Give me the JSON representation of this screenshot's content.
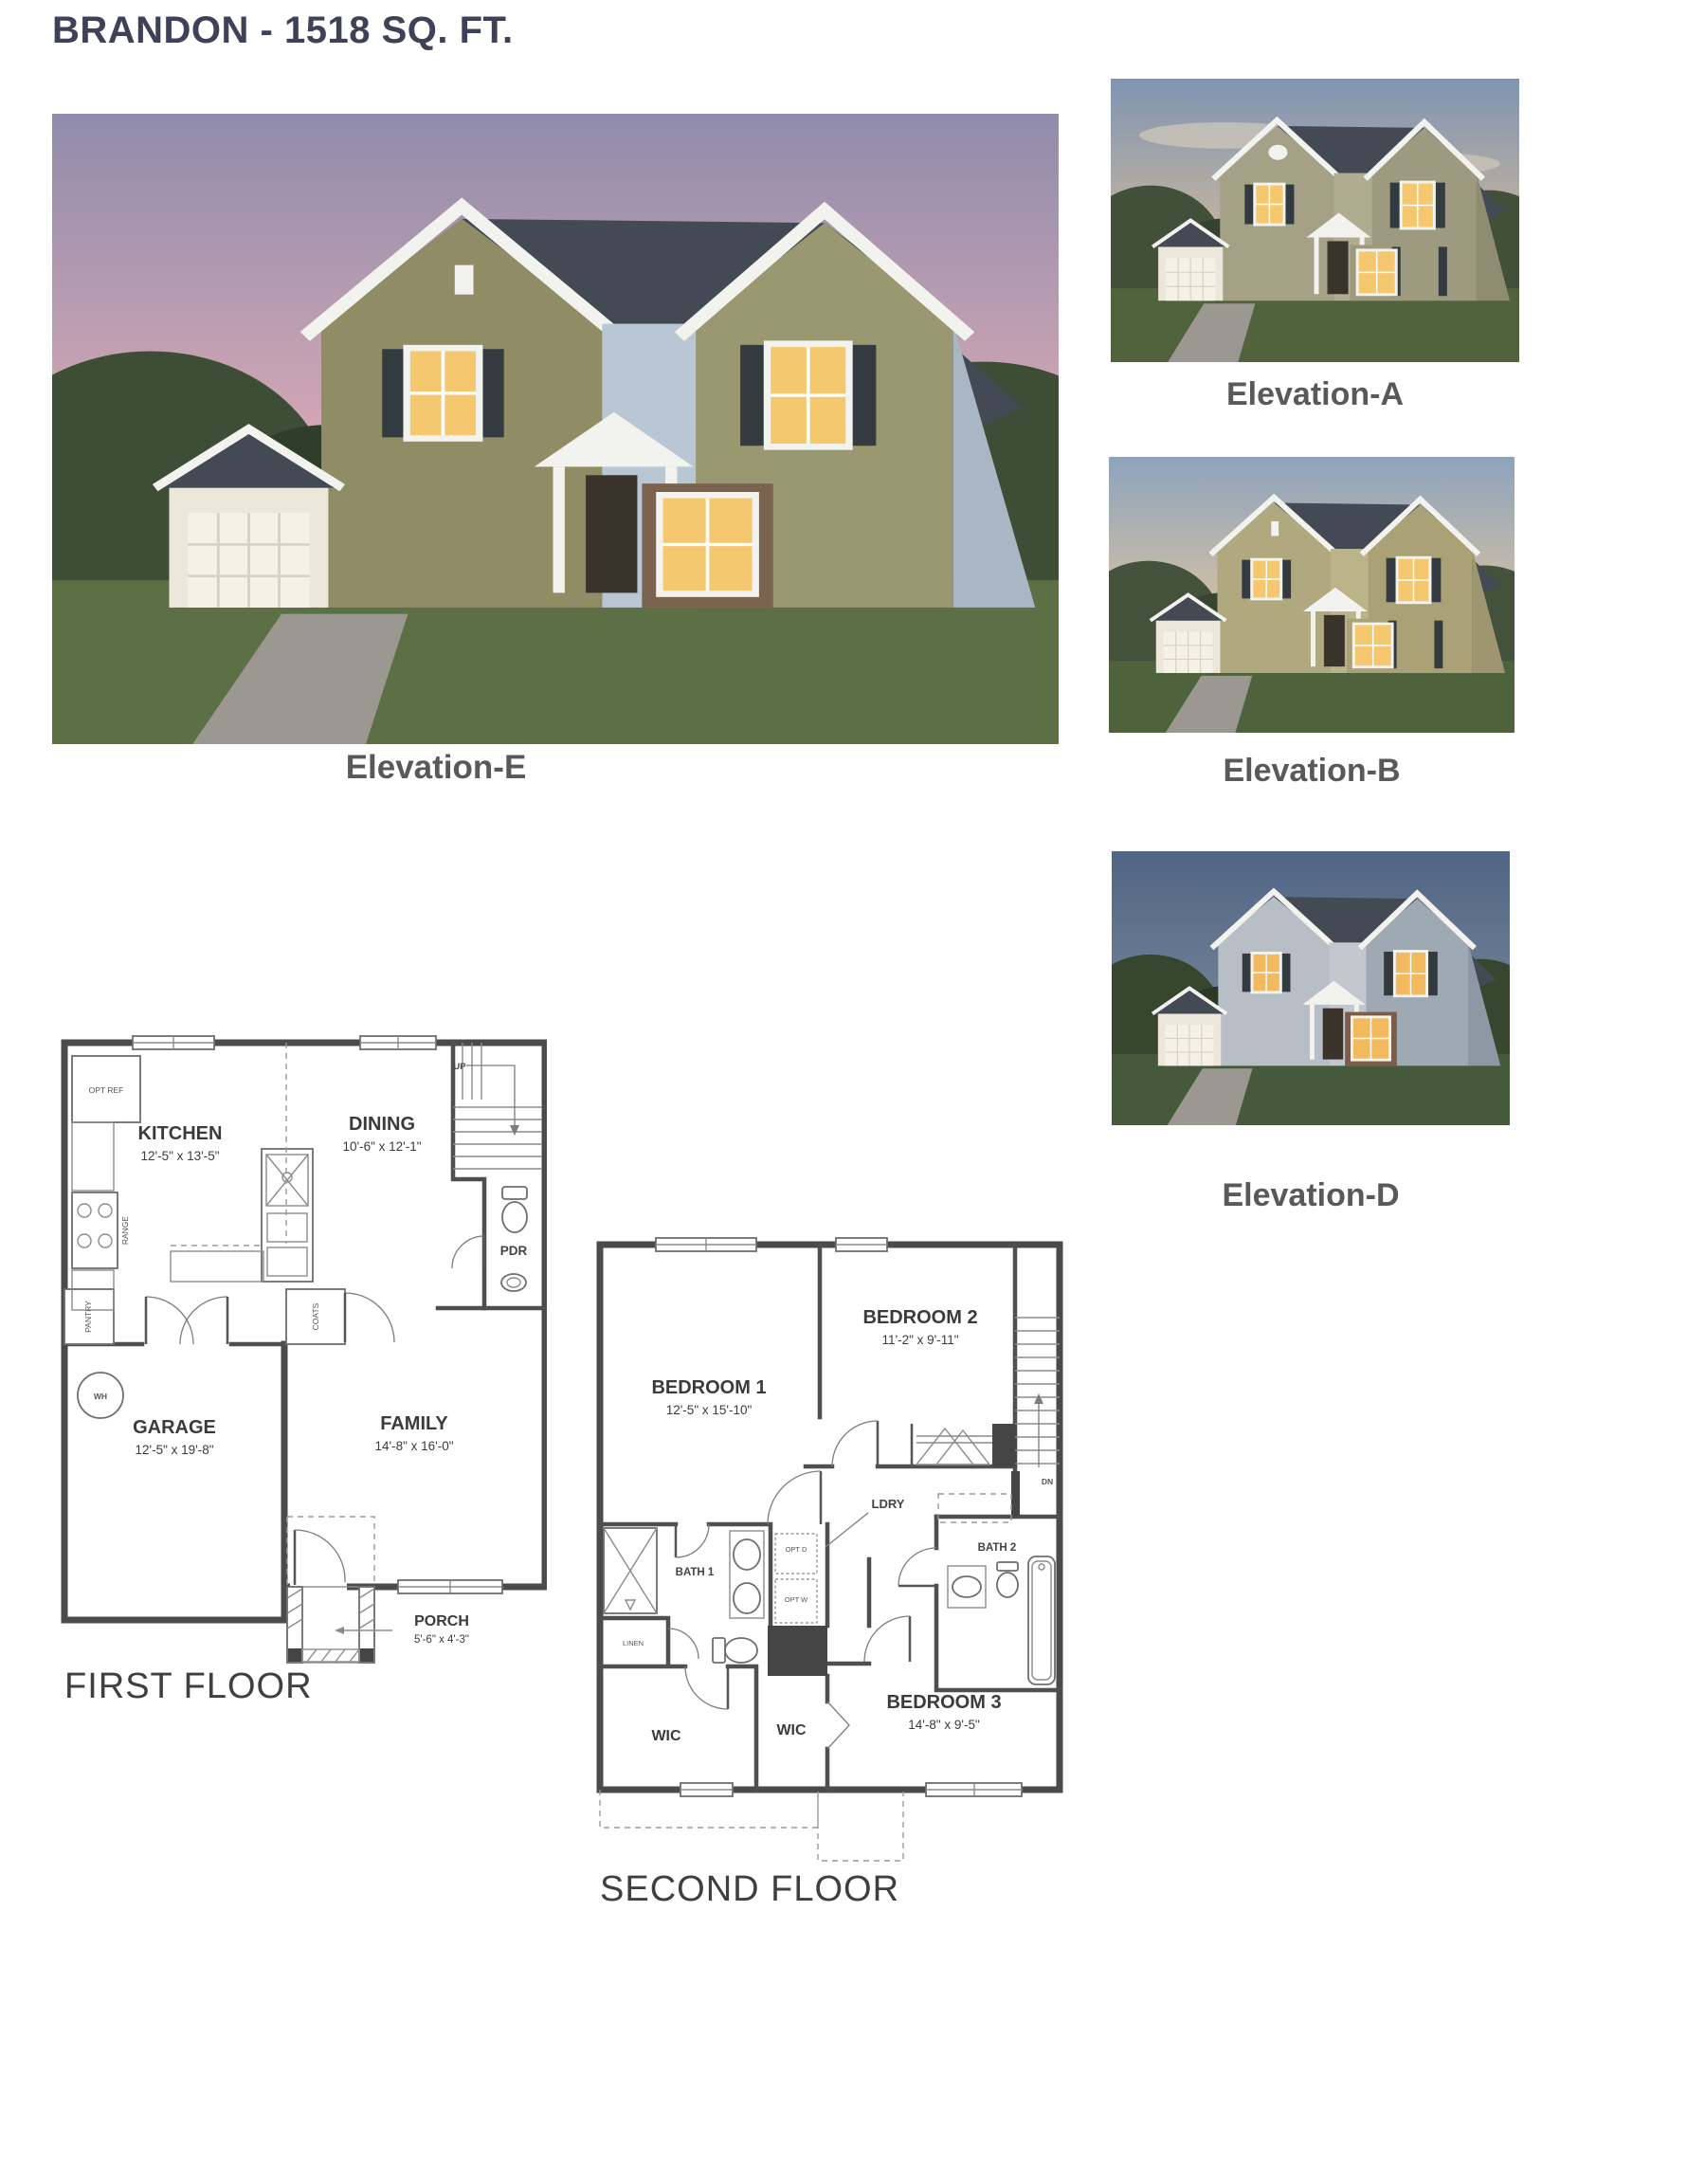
{
  "page": {
    "title": "BRANDON - 1518 SQ. FT."
  },
  "elevations": {
    "main": {
      "caption": "Elevation-E"
    },
    "thumbs": [
      {
        "caption": "Elevation-A"
      },
      {
        "caption": "Elevation-B"
      },
      {
        "caption": "Elevation-D"
      }
    ]
  },
  "first_floor": {
    "title": "FIRST FLOOR",
    "rooms": {
      "kitchen": {
        "name": "KITCHEN",
        "dims": "12'-5\" x 13'-5\""
      },
      "dining": {
        "name": "DINING",
        "dims": "10'-6\" x 12'-1\""
      },
      "garage": {
        "name": "GARAGE",
        "dims": "12'-5\" x 19'-8\""
      },
      "family": {
        "name": "FAMILY",
        "dims": "14'-8\" x 16'-0\""
      },
      "porch": {
        "name": "PORCH",
        "dims": "5'-6\" x 4'-3\""
      },
      "pdr": {
        "name": "PDR"
      }
    },
    "labels": {
      "opt_ref": "OPT REF",
      "range": "RANGE",
      "pantry": "PANTRY",
      "wh": "WH",
      "coats": "COATS",
      "up": "UP"
    }
  },
  "second_floor": {
    "title": "SECOND FLOOR",
    "rooms": {
      "bedroom1": {
        "name": "BEDROOM 1",
        "dims": "12'-5\" x 15'-10\""
      },
      "bedroom2": {
        "name": "BEDROOM 2",
        "dims": "11'-2\" x 9'-11\""
      },
      "bedroom3": {
        "name": "BEDROOM 3",
        "dims": "14'-8\" x 9'-5\""
      },
      "bath1": {
        "name": "BATH 1"
      },
      "bath2": {
        "name": "BATH 2"
      },
      "ldry": {
        "name": "LDRY"
      },
      "wic_left": {
        "name": "WIC"
      },
      "wic_mid": {
        "name": "WIC"
      },
      "linen": {
        "name": "LINEN"
      }
    },
    "labels": {
      "opt_d": "OPT D",
      "opt_w": "OPT W",
      "dn": "DN"
    }
  },
  "colors": {
    "title": "#3d4258",
    "caption": "#58595b",
    "plan_line": "#4b4b4b"
  }
}
